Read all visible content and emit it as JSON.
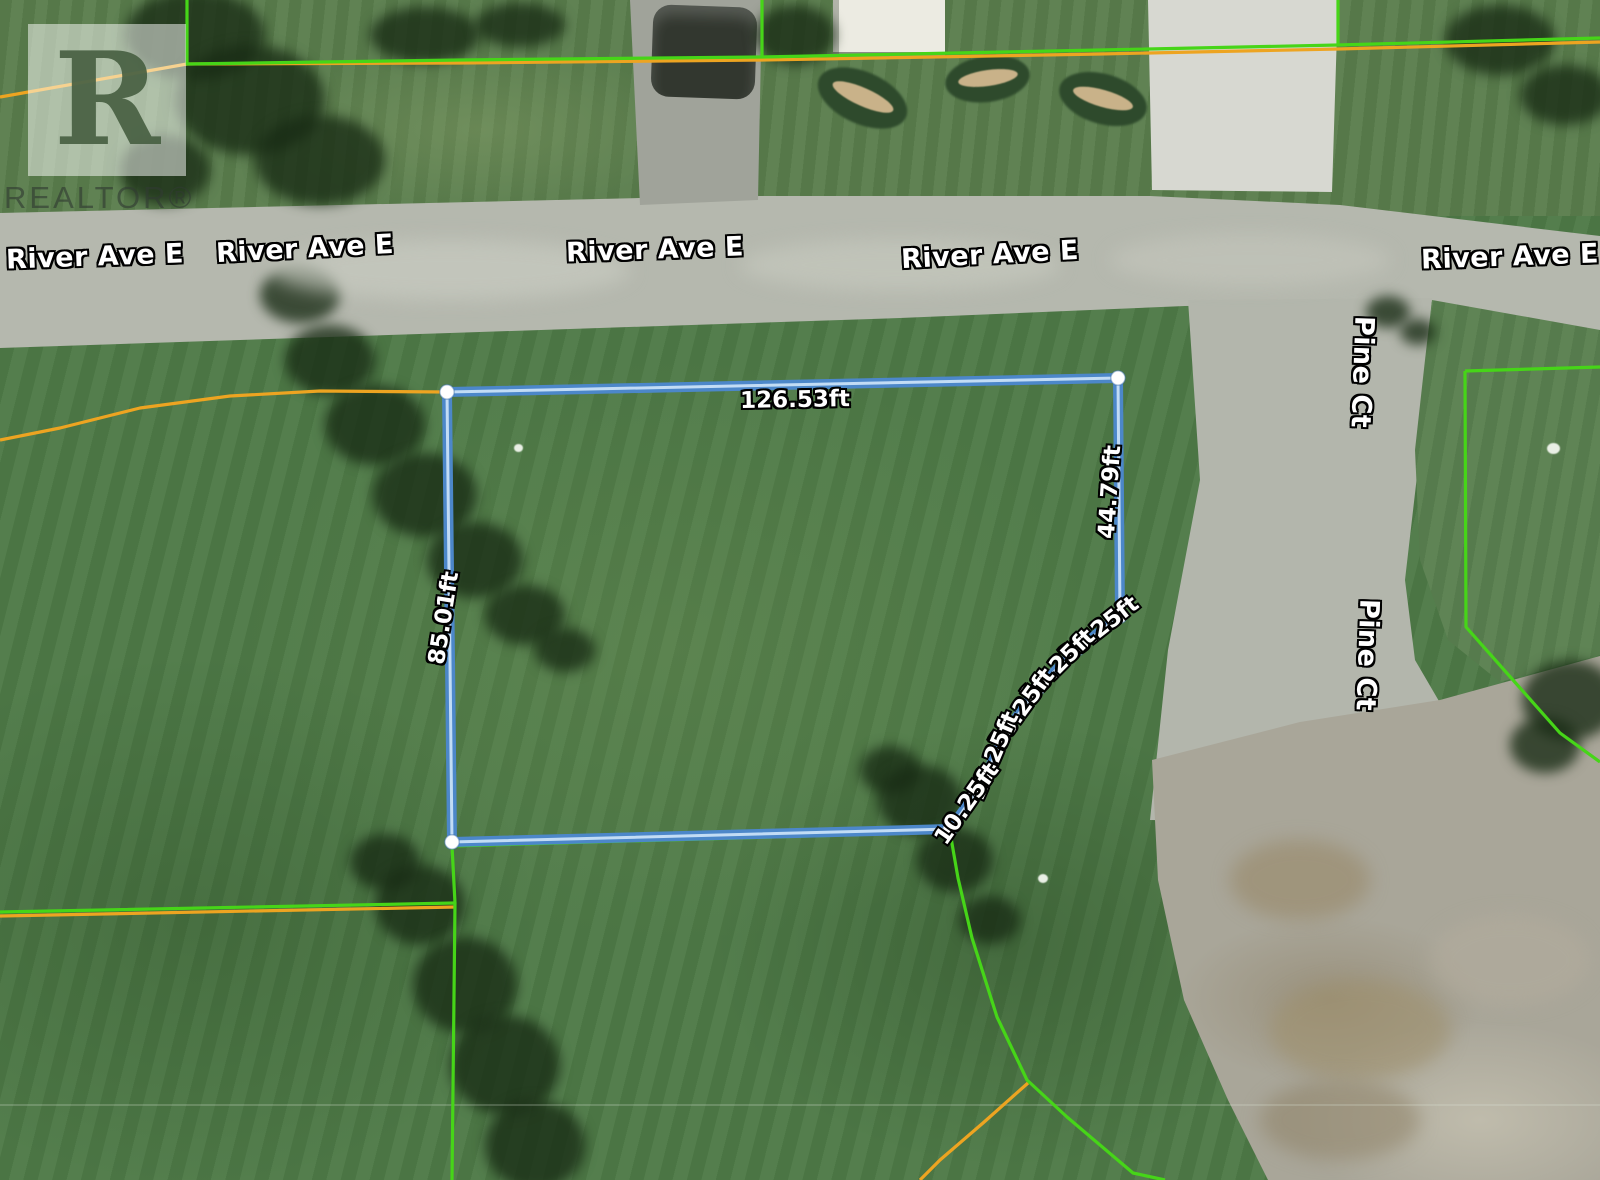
{
  "watermark": {
    "logo_letter": "R",
    "brand": "REALTOR®"
  },
  "labels": {
    "street": [
      {
        "text": "River Ave E",
        "x": 95,
        "y": 257,
        "rot": -2
      },
      {
        "text": "River Ave E",
        "x": 305,
        "y": 249,
        "rot": -3
      },
      {
        "text": "River Ave E",
        "x": 655,
        "y": 250,
        "rot": -2
      },
      {
        "text": "River Ave E",
        "x": 990,
        "y": 255,
        "rot": -3
      },
      {
        "text": "River Ave E",
        "x": 1510,
        "y": 257,
        "rot": -2
      },
      {
        "text": "Pine Ct",
        "x": 1362,
        "y": 372,
        "rot": 92
      },
      {
        "text": "Pine Ct",
        "x": 1367,
        "y": 655,
        "rot": 92
      }
    ],
    "measurements": [
      {
        "text": "126.53ft",
        "x": 795,
        "y": 400,
        "rot": -1
      },
      {
        "text": "44.79ft",
        "x": 1110,
        "y": 492,
        "rot": -86
      },
      {
        "text": "85.01ft",
        "x": 444,
        "y": 618,
        "rot": -81
      },
      {
        "text": "10.25ft",
        "x": 1099,
        "y": 630,
        "rot": -38
      },
      {
        "text": "10.25ft",
        "x": 1058,
        "y": 666,
        "rot": -45
      },
      {
        "text": "10.25ft",
        "x": 1022,
        "y": 709,
        "rot": -54
      },
      {
        "text": "10.25ft",
        "x": 994,
        "y": 756,
        "rot": -67
      },
      {
        "text": "10.25ft",
        "x": 967,
        "y": 804,
        "rot": -55
      }
    ]
  },
  "parcel": {
    "vertices": [
      [
        447,
        392
      ],
      [
        1118,
        378
      ],
      [
        1120,
        616
      ],
      [
        1077,
        649
      ],
      [
        1038,
        688
      ],
      [
        1004,
        734
      ],
      [
        983,
        783
      ],
      [
        950,
        829
      ],
      [
        452,
        842
      ]
    ],
    "side_lengths_ft": {
      "north": "126.53",
      "east": "44.79",
      "west": "85.01",
      "arc_segments": "10.25"
    }
  },
  "geometry": {
    "parcel": "M447,392 L1118,378 L1120,616 L1077,649 L1038,688 L1004,734 L983,783 L950,829 L452,842 Z",
    "green_top": "M187,0 L187,64 L460,60 L762,57 L1100,50 L1338,45 L1600,38",
    "green_verticals": "M762,0 L762,57 M1338,0 L1338,45",
    "green_right": "M1465,371 L1600,367 M1465,371 L1466,627 L1560,733 L1600,762",
    "green_bottom_left": "M0,912 L455,903 L452,1180",
    "green_arc": "M950,832 L958,878 L972,938 L997,1017 L1027,1080 L1067,1117 L1133,1173 L1165,1180",
    "green_lot_bottom": "M452,846 L950,832 M452,846 L455,903",
    "orange_top": "M0,97 L187,64 L460,63 L762,60 L1100,54 L1338,49 L1600,42",
    "orange_mid_left": "M0,440 L60,428 L140,408 L230,396 L320,391 L447,392",
    "orange_bottom_right": "M1028,1083 L983,1123 L940,1160 L920,1180",
    "orange_bottom_left": "M0,916 L455,907"
  },
  "colors": {
    "parcel_blue": "#4c87c9",
    "parcel_core": "#cfe5fa",
    "vertex_dot": "#ffffff",
    "boundary_green": "#46d518",
    "boundary_orange": "#eda421",
    "label_text": "#ffffff",
    "label_outline": "#000000",
    "grass": "#4e7a47",
    "road": "#b5b8ae",
    "gravel": "#a9a699"
  }
}
